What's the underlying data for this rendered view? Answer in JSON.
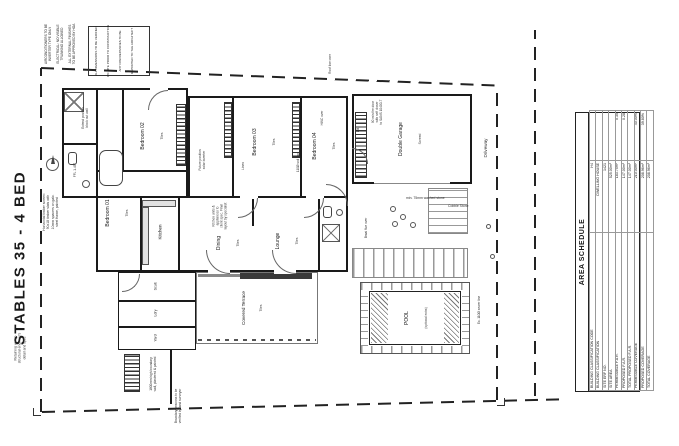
{
  "sheet": {
    "title": "STABLES 35 - 4 BED"
  },
  "area_schedule": {
    "title": "AREA SCHEDULE",
    "rows": [
      {
        "label": "BUILDING CLASSIFICATION CODE",
        "value": "H4",
        "ratio": ""
      },
      {
        "label": "BUILDING CLASSIFICATION",
        "value": "DWELLING HOUSE",
        "ratio": ""
      },
      {
        "label": "SITE ERF NO.",
        "value": "1421",
        "ratio": ""
      },
      {
        "label": "SITE AREA",
        "value": "525.00m²",
        "ratio": ""
      },
      {
        "label": "PERMISSIBLE F.A.R.",
        "value": "183.75m²",
        "ratio": "0.35"
      },
      {
        "label": "PROPOSED F.A.R.",
        "value": "147.00m²",
        "ratio": "0.28"
      },
      {
        "label": "TOTAL PROPOSED F.A.R.",
        "value": "147.00m²",
        "ratio": ""
      },
      {
        "label": "PERMISSIBLE COVERAGE",
        "value": "210.00m²",
        "ratio": "40.00%"
      },
      {
        "label": "PROPOSED COVERAGE",
        "value": "208.96m²",
        "ratio": "39.80%"
      },
      {
        "label": "TOTAL COVERAGE",
        "value": "208.96m²",
        "ratio": ""
      }
    ]
  },
  "rooms": {
    "bedroom01": {
      "label": "Bedroom 01",
      "finish": "Tiles"
    },
    "bedroom02": {
      "label": "Bedroom 02",
      "finish": "Tiles"
    },
    "bedroom03": {
      "label": "Bedroom 03",
      "finish": "Tiles"
    },
    "bedroom04": {
      "label": "Bedroom 04",
      "finish": "Tiles"
    },
    "kitchen": {
      "label": "Kitchen",
      "finish": "Tiles"
    },
    "dining": {
      "label": "Dining",
      "finish": "Tiles"
    },
    "lounge": {
      "label": "Lounge",
      "finish": "Tiles"
    },
    "terrace": {
      "label": "Covered Terrace",
      "finish": "Tiles"
    },
    "scullery": {
      "label": "Scull."
    },
    "laundry": {
      "label": "Ldry"
    },
    "yard": {
      "label": "Yard"
    },
    "garage": {
      "label": "Double Garage",
      "finish": "Screed"
    },
    "pool": {
      "label": "POOL",
      "finish": "(optional extra)"
    },
    "driveway": {
      "label": "Driveway"
    }
  },
  "notes": {
    "ac": "AIRCONDITIONERS TO BE\nINVERTER TYPE ONLY",
    "trunking": "ELECTRICAL: NO VISIBLE\nTRUNKING ALLOWED",
    "approved": "ALL EXTERNAL FINISHES\nTO BE APPROVED BY HOA",
    "stamp": [
      "ALL DIMENSIONS TO BE VERIFIED",
      "ON SITE PRIOR TO CONSTRUCTION",
      "ANY DISCREPANCIES TO BE",
      "REPORTED TO THE ARCHITECT"
    ],
    "timber_screen": "Horizontal timber screen:\n90x18 timber slats with\n10mm spacers on galv.\nsteel frame, painted",
    "retaining": "Retaining wall to\nstructural engineer's\ndetail and spec",
    "fire_door": "90 min fire door\nwith self closer\nto SANS 10400-T",
    "kitchen_spec": "Kitchen units &\nappliances to\nclient spec. Final\nlayout by specialist",
    "washed_stone": "min. 75mm washed stone",
    "cobble": "Cobble Stone",
    "boundary_wall": "1800mm high boundary\nwall, plastered & painted",
    "planting": "Boundary beacons to be\nverified by land surveyor",
    "sewer": "Ex. 110Ø sewer line",
    "micro": [
      "Extend position\nblock out wall",
      "Future position\nsolar inverter",
      "Linen",
      "110Ø soil pipe",
      "DB",
      "HWC over",
      "Roof line over",
      "FFL 1.457",
      "Braai flue over"
    ]
  },
  "colors": {
    "ink": "#1a1a1a",
    "line": "#555",
    "faint": "#888"
  }
}
